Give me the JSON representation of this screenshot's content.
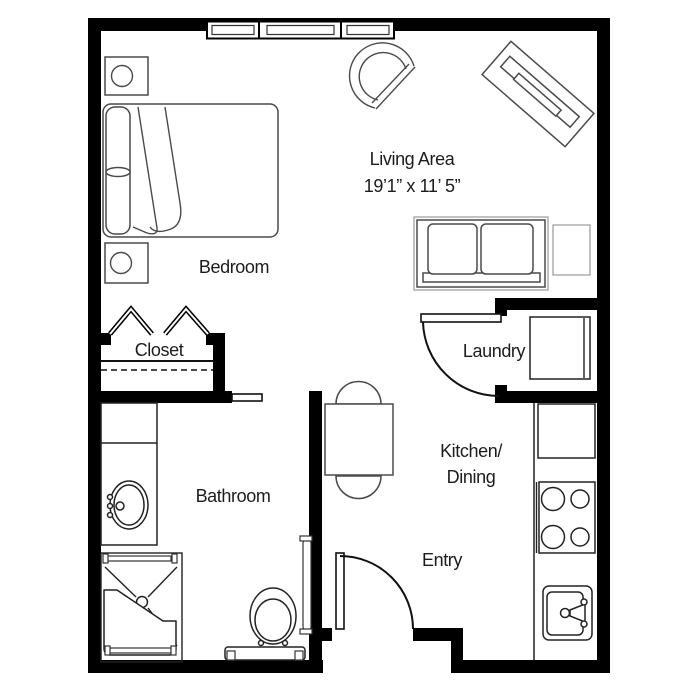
{
  "floor_plan": {
    "type": "studio-apartment-floor-plan",
    "rooms": {
      "living_area": {
        "label": "Living Area",
        "dimensions": "19’1” x 11’ 5”"
      },
      "bedroom": {
        "label": "Bedroom"
      },
      "closet": {
        "label": "Closet"
      },
      "laundry": {
        "label": "Laundry"
      },
      "kitchen_dining": {
        "label_line_1": "Kitchen/",
        "label_line_2": "Dining"
      },
      "bathroom": {
        "label": "Bathroom"
      },
      "entry": {
        "label": "Entry"
      }
    },
    "fixtures": [
      "window",
      "bifold-closet-doors",
      "pocket-door",
      "laundry-door",
      "entry-door",
      "washer",
      "refrigerator",
      "range",
      "kitchen-sink",
      "kitchen-counter",
      "vanity-sink",
      "shower-with-bench",
      "toilet",
      "grab-bar"
    ],
    "furniture": [
      "bed",
      "nightstand",
      "nightstand",
      "armchair",
      "tv-console",
      "loveseat",
      "end-table",
      "dining-table",
      "dining-chair",
      "dining-chair"
    ],
    "colors": {
      "background": "#ffffff",
      "walls": "#000000",
      "fixture_outline": "#222222",
      "furniture_outline": "#4a4a4a",
      "furniture_halo": "#9a9a9a",
      "text": "#1c1c1c"
    }
  }
}
